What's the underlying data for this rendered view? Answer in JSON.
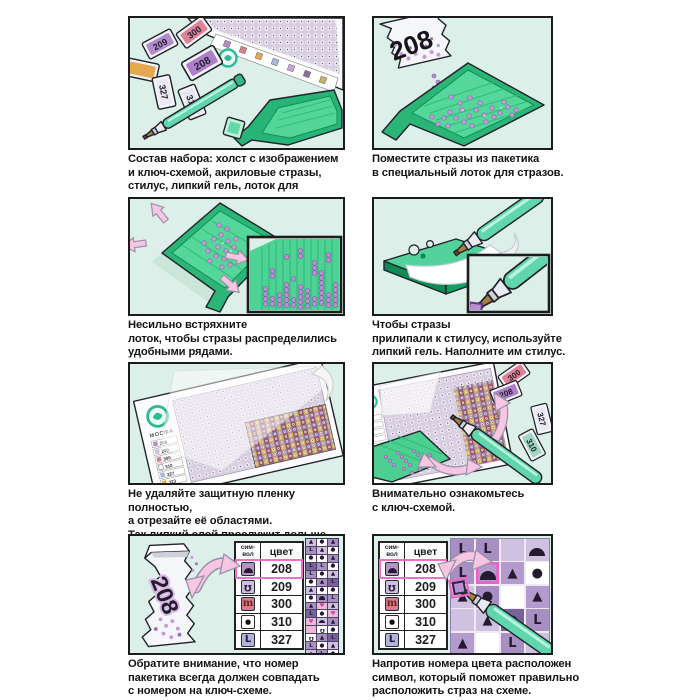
{
  "sheet": {
    "background": "#ffffff",
    "panel_bg": "#ddefe9",
    "panel_border": "#1b1b1b"
  },
  "colors": {
    "mint": "#ddefe9",
    "tray_green": "#4ccf90",
    "tray_dark": "#0f8f57",
    "bead_purple": "#c79fd8",
    "arrow_pink": "#f6c6e2",
    "highlight_pink": "#f06ec8",
    "stylus_teal": "#5fd6ae",
    "logo_teal": "#2cb995",
    "nib_brown": "#a97c3f"
  },
  "captions": {
    "p1": "Состав набора: холст с изображением\nи ключ-схемой, акриловые стразы,\nстилус, липкий гель, лоток для стразов.",
    "p2": "Поместите стразы из пакетика\nв специальный лоток для стразов.",
    "p3": "Несильно встряхните\nлоток, чтобы стразы распределились\nудобными рядами.",
    "p4": "Чтобы стразы\nприлипали к стилусу, используйте\nлипкий гель. Наполните им стилус.",
    "p5": "Не удаляйте защитную пленку полностью,\nа отрезайте её областями.\nТак липкий слой прослужит дольше.",
    "p6": "Внимательно ознакомьтесь\nс ключ-схемой.",
    "p7": "Обратите внимание, что номер\nпакетика всегда должен совпадать\nс номером на ключ-схеме.",
    "p8": "Напротив номера цвета расположен\nсимвол, который поможет правильно\nрасположить страз на схеме."
  },
  "packets": {
    "kit": [
      "209",
      "300",
      "208",
      "327",
      "310"
    ],
    "pour": "208",
    "chart": [
      "300",
      "208",
      "327",
      "310"
    ],
    "match": "208"
  },
  "canvas": {
    "brand": "МОСФА",
    "key_numbers": [
      "208",
      "209",
      "300",
      "310",
      "327",
      "323"
    ]
  },
  "key_table": {
    "header_symbol": "сим-\nвол",
    "header_color": "цвет",
    "rows": [
      {
        "symbol": "dome",
        "number": "208",
        "bg": "#b193c6",
        "highlight": true
      },
      {
        "symbol": "hook",
        "number": "209",
        "bg": "#cfc0e2",
        "highlight": false
      },
      {
        "symbol": "arch",
        "number": "300",
        "bg": "#d2808d",
        "highlight": false
      },
      {
        "symbol": "dot",
        "number": "310",
        "bg": "#ffffff",
        "highlight": false
      },
      {
        "symbol": "letter-L",
        "number": "327",
        "bg": "#aeb4dd",
        "highlight": false
      }
    ]
  },
  "grids": {
    "strip": {
      "cols": 3,
      "rows": [
        "t:l,d:w,t:p",
        "L:p,t:l,d:w",
        "d:w,d:w,t:p",
        "L:k,L:p,d:w",
        "L:p,d:w,t:l",
        "d:w,t:p,L:k",
        "t:l,d:w,d:w",
        "d:w,a:p,L:p",
        "t:p,h:r,t:l",
        "L:k,d:w,h:r",
        "h:r,a:l,t:p",
        "x:r,o:w,d:w",
        "o:w,t:p,L:k",
        "L:p,d:w,t:l",
        "t:l,L:p,d:w",
        "d:w,t:l,a:p"
      ]
    },
    "board": {
      "cols": 4,
      "rows": [
        "L:p,L:p,x:l,a:l",
        "L:p,A:m,t:m,d:w",
        "t:l,d:p,x:w,t:m",
        "x:l,t:l,d:k,L:p",
        "t:m,x:w,L:p,t:l"
      ]
    }
  }
}
